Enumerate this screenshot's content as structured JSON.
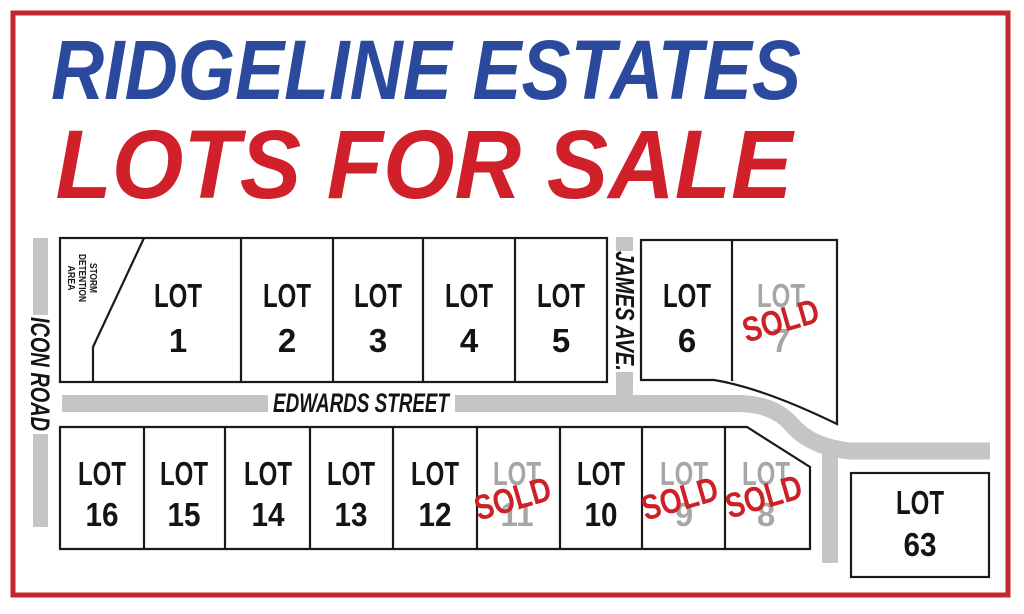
{
  "flyer": {
    "title_line1": "RIDGELINE ESTATES",
    "title_line2": "LOTS FOR SALE"
  },
  "roads": {
    "icon_road": "ICON ROAD",
    "edwards_street": "EDWARDS STREET",
    "james_ave": "JAMES AVE."
  },
  "labels": {
    "lot_word": "LOT",
    "sold_stamp": "SOLD",
    "storm_detention": [
      "STORM",
      "DETENTION",
      "AREA"
    ]
  },
  "lots": [
    {
      "number": "1",
      "status": "available"
    },
    {
      "number": "2",
      "status": "available"
    },
    {
      "number": "3",
      "status": "available"
    },
    {
      "number": "4",
      "status": "available"
    },
    {
      "number": "5",
      "status": "available"
    },
    {
      "number": "6",
      "status": "available"
    },
    {
      "number": "7",
      "status": "sold"
    },
    {
      "number": "8",
      "status": "sold"
    },
    {
      "number": "9",
      "status": "sold"
    },
    {
      "number": "10",
      "status": "available"
    },
    {
      "number": "11",
      "status": "sold"
    },
    {
      "number": "12",
      "status": "available"
    },
    {
      "number": "13",
      "status": "available"
    },
    {
      "number": "14",
      "status": "available"
    },
    {
      "number": "15",
      "status": "available"
    },
    {
      "number": "16",
      "status": "available"
    },
    {
      "number": "63",
      "status": "available"
    }
  ],
  "colors": {
    "title_blue": "#2b4a9e",
    "title_red": "#d0212a",
    "border_red": "#c2272d",
    "road_gray": "#c5c5c5",
    "lot_line_black": "#1a1a1a",
    "sold_text_gray": "#a6a6a6",
    "sold_stamp_red": "#cb2127"
  }
}
